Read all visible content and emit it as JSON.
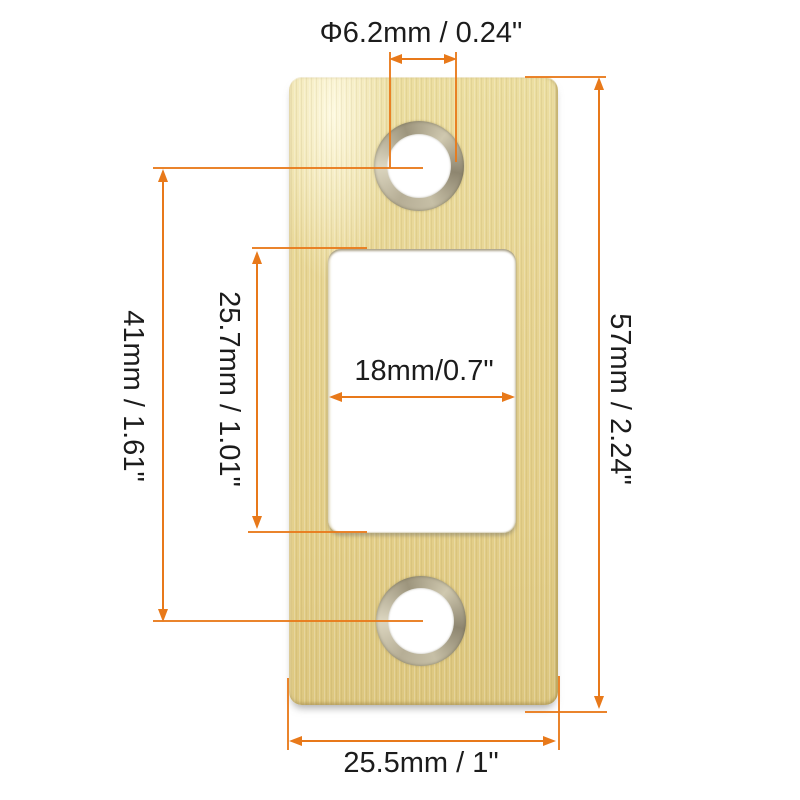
{
  "figure": {
    "object": "gold-strike-plate",
    "background_color": "#ffffff",
    "colors": {
      "plate_gold": "#e7d492",
      "countersink_ring": "#b3ab93",
      "dimension_line": "#e8791a",
      "label_text": "#1c1c1c"
    },
    "dimensions": {
      "hole_diameter": {
        "label": "Φ6.2mm / 0.24\""
      },
      "hole_spacing": {
        "label": "41mm / 1.61\""
      },
      "cutout_height": {
        "label": "25.7mm / 1.01\""
      },
      "cutout_width": {
        "label": "18mm/0.7\""
      },
      "plate_height": {
        "label": "57mm / 2.24\""
      },
      "plate_width": {
        "label": "25.5mm / 1\""
      }
    }
  }
}
